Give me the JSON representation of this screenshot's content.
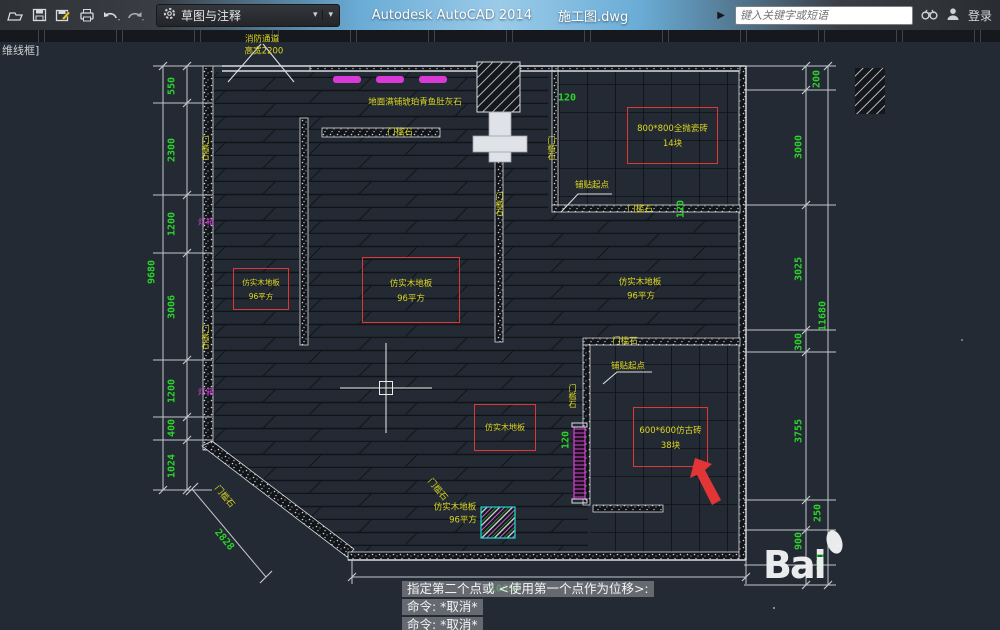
{
  "titlebar": {
    "app_title": "Autodesk AutoCAD 2014",
    "doc_title": "施工图.dwg",
    "workspace_label": "草图与注释",
    "search_placeholder": "键入关键字或短语",
    "login_label": "登录",
    "icons": [
      "open-icon",
      "save-icon",
      "save-as-icon",
      "print-icon",
      "undo-icon",
      "redo-icon",
      "workspace-gear-icon",
      "binoculars-icon",
      "user-icon"
    ]
  },
  "viewport_label": "维线框]",
  "colors": {
    "dim_green": "#2bd42b",
    "label_yellow": "#ddd821",
    "magenta": "#d940d9",
    "red_box": "#e23535",
    "cyan": "#22d6d6"
  },
  "plan": {
    "notes": {
      "fire_lane_1": "消防通道",
      "fire_lane_2": "高宽2200",
      "floor_note": "地面满铺琥珀青鱼肚灰石",
      "threshold": "门槛石",
      "paving_start": "铺贴起点",
      "light_box": "灯箱",
      "wood_floor": "仿实木地板",
      "wood_floor_area": "96平方",
      "tile_800_name": "800*800全抛瓷砖",
      "tile_800_qty": "14块",
      "tile_600_name": "600*600仿古砖",
      "tile_600_qty": "38块"
    },
    "dims": {
      "left_chain": [
        "550",
        "2300",
        "1200",
        "3006",
        "1200",
        "400",
        "1024"
      ],
      "left_total": "9680",
      "right_chain": [
        "200",
        "3000",
        "3025",
        "300",
        "3755",
        "250",
        "900",
        "150"
      ],
      "right_total": "11680",
      "bottom_total": "10650",
      "diagonal": "2828",
      "offset_120_a": "120",
      "offset_120_b": "120",
      "offset_120_c": "120"
    }
  },
  "command_line": {
    "prompt": "指定第二个点或 <使用第一个点作为位移>:",
    "history_1": "命令: *取消*",
    "history_2": "命令: *取消*"
  },
  "watermark": "Bai"
}
